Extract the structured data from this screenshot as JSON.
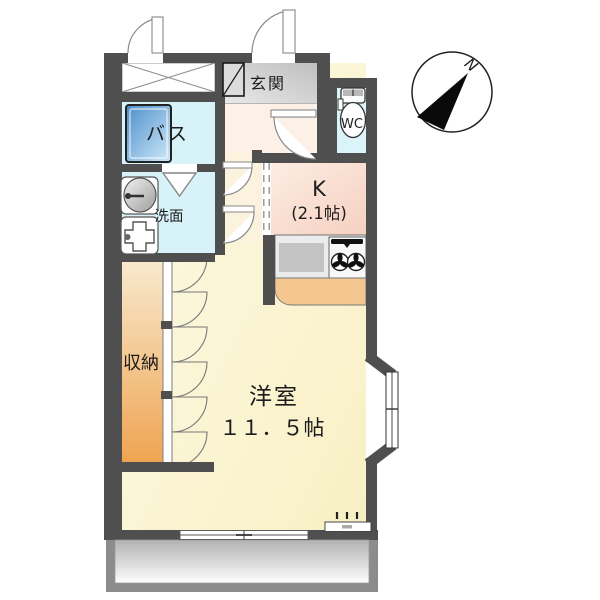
{
  "plan": {
    "compass": {
      "north_label": "N"
    },
    "rooms": {
      "genkan": {
        "label": "玄関"
      },
      "bath": {
        "label": "バス"
      },
      "washroom": {
        "label": "洗面"
      },
      "wc": {
        "label": "WC"
      },
      "kitchen": {
        "label": "K",
        "size": "(2.1帖)"
      },
      "storage": {
        "label": "収納"
      },
      "main_room": {
        "label": "洋室",
        "size": "１１．５帖"
      }
    },
    "colors": {
      "wall": "#4f4f4f",
      "water_rooms": "#d7f2f8",
      "kitchen_floor": "#f8dccb",
      "main_room_floor": "#faf3cd",
      "storage_fill": "#efa452",
      "genkan_floor": "#cccccc",
      "hall_floor": "#fdf0e6",
      "bathtub": "#4e8ecb",
      "counter": "#f3c78f",
      "balcony_frame": "#8c8c8c"
    }
  }
}
